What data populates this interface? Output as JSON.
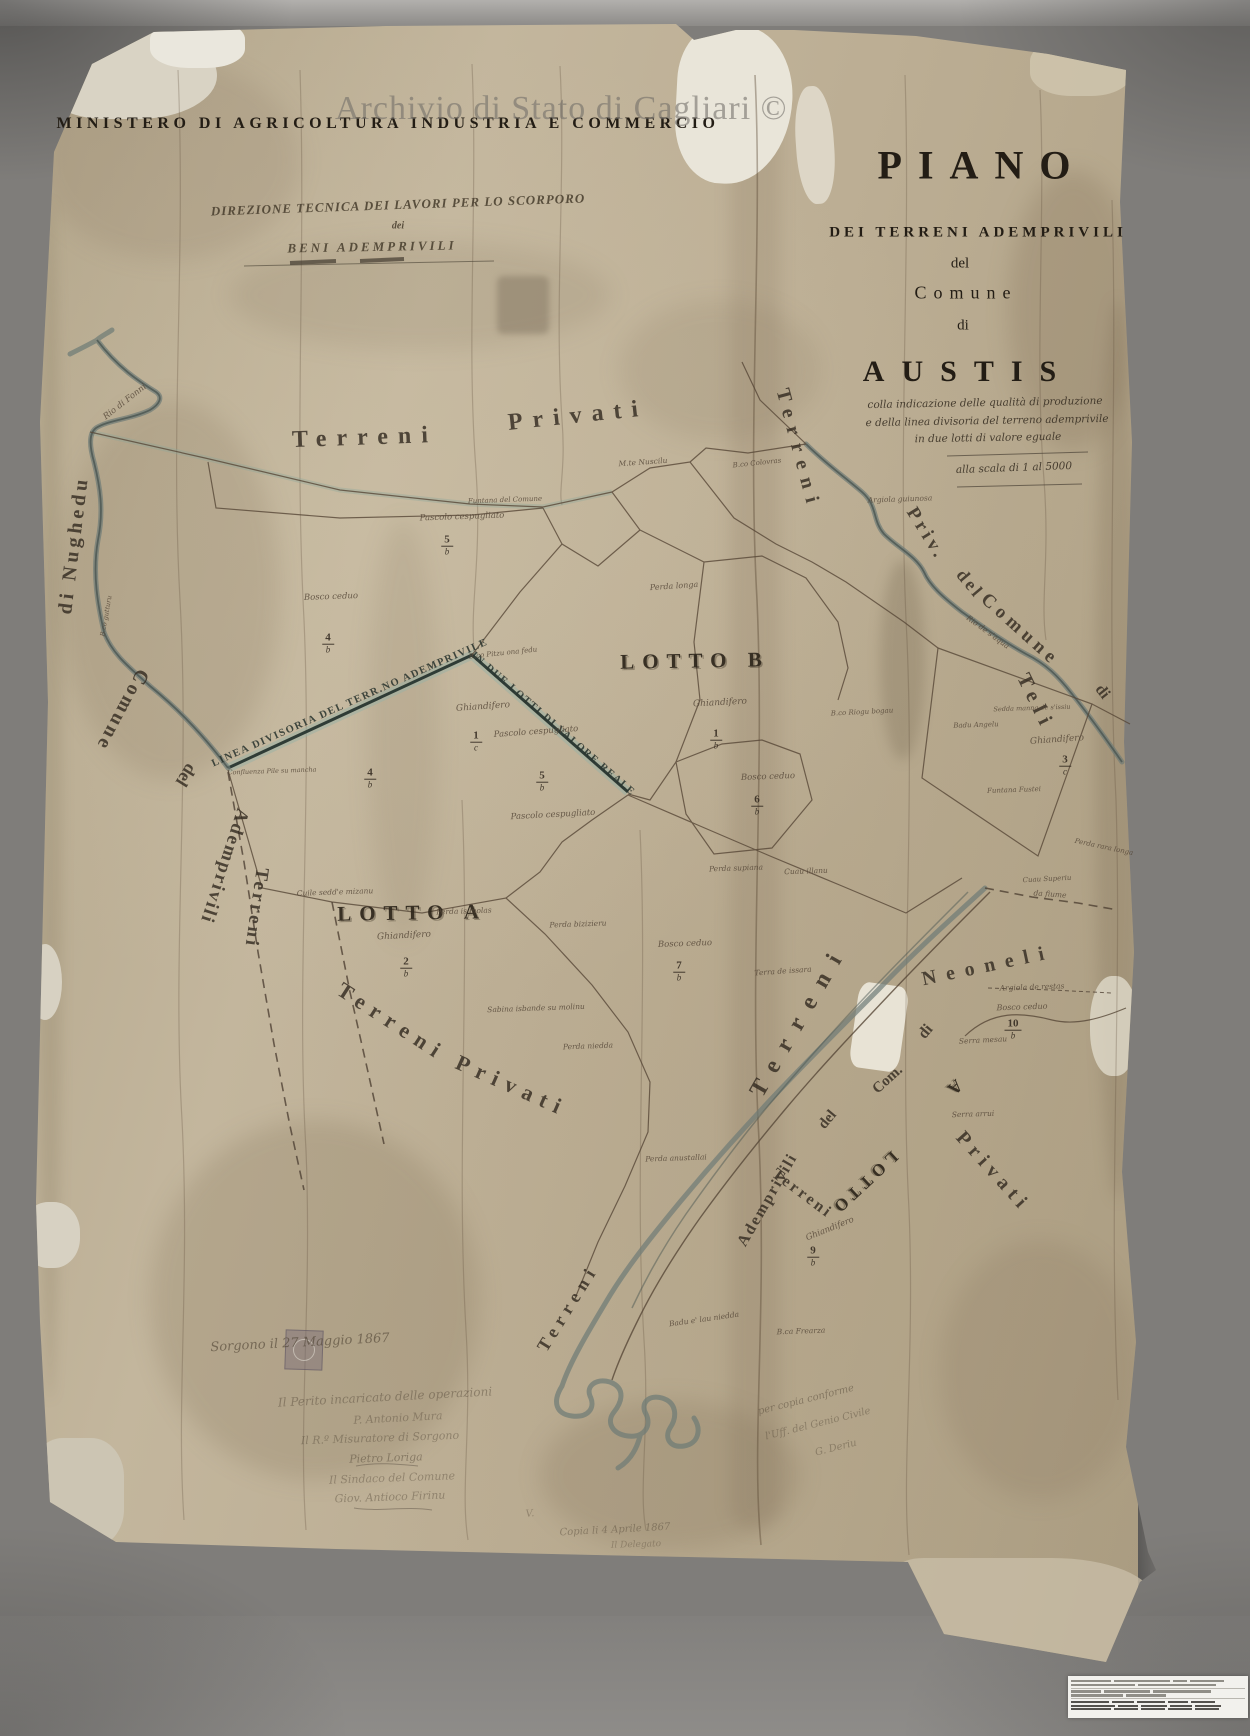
{
  "watermark": {
    "text": "Archivio di Stato di Cagliari ©"
  },
  "header": {
    "ministry": "MINISTERO DI AGRICOLTURA INDUSTRIA E COMMERCIO",
    "direction_line1": "DIREZIONE TECNICA DEI LAVORI PER LO SCORPORO",
    "direction_line2": "dei",
    "direction_line3": "BENI ADEMPRIVILI"
  },
  "title_block": {
    "title": "PIANO",
    "line1": "DEI TERRENI ADEMPRIVILI",
    "line2": "del",
    "line3": "Comune",
    "line4": "di",
    "comune": "AUSTIS",
    "sub1": "colla indicazione delle qualità di produzione",
    "sub2": "e della linea divisoria del terreno ademprivile",
    "sub3": "in due lotti di valore eguale",
    "scale": "alla scala di 1 al 5000"
  },
  "map": {
    "area_labels": [
      {
        "text": "Terreni",
        "x": 365,
        "y": 438,
        "rot": -2,
        "size": 24,
        "ls": 10
      },
      {
        "text": "Privati",
        "x": 578,
        "y": 416,
        "rot": -6,
        "size": 24,
        "ls": 10
      },
      {
        "text": "Terreni",
        "x": 392,
        "y": 1022,
        "rot": 33,
        "size": 22,
        "ls": 8
      },
      {
        "text": "Privati",
        "x": 512,
        "y": 1086,
        "rot": 24,
        "size": 22,
        "ls": 8
      },
      {
        "text": "Terreni",
        "x": 798,
        "y": 450,
        "rot": 75,
        "size": 20,
        "ls": 9
      },
      {
        "text": "Priv.",
        "x": 926,
        "y": 534,
        "rot": 58,
        "size": 19,
        "ls": 4
      },
      {
        "text": "del",
        "x": 970,
        "y": 584,
        "rot": 50,
        "size": 18,
        "ls": 3
      },
      {
        "text": "Comune",
        "x": 1020,
        "y": 630,
        "rot": 42,
        "size": 19,
        "ls": 5
      },
      {
        "text": "di",
        "x": 1102,
        "y": 692,
        "rot": 52,
        "size": 16
      },
      {
        "text": "Teli",
        "x": 1036,
        "y": 702,
        "rot": 64,
        "size": 21,
        "ls": 7
      },
      {
        "text": "di Nughedu",
        "x": 74,
        "y": 545,
        "rot": -83,
        "size": 20,
        "ls": 4
      },
      {
        "text": "Comune",
        "x": 122,
        "y": 710,
        "rot": 118,
        "size": 20,
        "ls": 3
      },
      {
        "text": "del",
        "x": 186,
        "y": 775,
        "rot": 122,
        "size": 18
      },
      {
        "text": "Ademprivili",
        "x": 224,
        "y": 866,
        "rot": 108,
        "size": 19,
        "ls": 2
      },
      {
        "text": "Terreni",
        "x": 256,
        "y": 908,
        "rot": 98,
        "size": 19,
        "ls": 3
      },
      {
        "text": "Terreni",
        "x": 800,
        "y": 1020,
        "rot": -60,
        "size": 24,
        "ls": 14
      },
      {
        "text": "Ademprivili",
        "x": 768,
        "y": 1200,
        "rot": -60,
        "size": 16,
        "ls": 2
      },
      {
        "text": "del",
        "x": 828,
        "y": 1120,
        "rot": -50,
        "size": 15
      },
      {
        "text": "Com.",
        "x": 888,
        "y": 1080,
        "rot": -42,
        "size": 15
      },
      {
        "text": "di",
        "x": 926,
        "y": 1032,
        "rot": -50,
        "size": 16
      },
      {
        "text": "Neoneli",
        "x": 988,
        "y": 966,
        "rot": -12,
        "size": 20,
        "ls": 10
      },
      {
        "text": "Terreni",
        "x": 568,
        "y": 1308,
        "rot": -58,
        "size": 18,
        "ls": 6
      },
      {
        "text": "Terreni",
        "x": 802,
        "y": 1194,
        "rot": 37,
        "size": 16,
        "ls": 3
      },
      {
        "text": "Privati",
        "x": 993,
        "y": 1172,
        "rot": 48,
        "size": 20,
        "ls": 6
      }
    ],
    "lot_labels": [
      {
        "text": "LOTTO B",
        "x": 695,
        "y": 661,
        "rot": -1,
        "size": 21,
        "ls": 8
      },
      {
        "text": "LOTTO A",
        "x": 412,
        "y": 913,
        "rot": -1,
        "size": 21,
        "ls": 8
      },
      {
        "text": "LOTTO",
        "x": 864,
        "y": 1183,
        "rot": 137,
        "size": 17,
        "ls": 5
      },
      {
        "text": "A",
        "x": 955,
        "y": 1087,
        "rot": 137,
        "size": 18
      }
    ],
    "captions": [
      {
        "text": "LINEA DIVISORIA DEL TERR.NO ADEMPRIVILE",
        "x": 350,
        "y": 703,
        "rot": -24,
        "size": 10.5,
        "ls": 1.5
      },
      {
        "text": "IN DUE LOTTI DI VALORE REALE",
        "x": 553,
        "y": 724,
        "rot": 41,
        "size": 10.5,
        "ls": 1.5
      }
    ],
    "small_labels": [
      {
        "text": "Rio di Fonni",
        "x": 125,
        "y": 402,
        "rot": -38,
        "size": 8.5
      },
      {
        "text": "B.co gutturu",
        "x": 106,
        "y": 616,
        "rot": -80,
        "size": 6.5
      },
      {
        "text": "M.te Nuscilu",
        "x": 643,
        "y": 462,
        "rot": -4,
        "size": 7.5
      },
      {
        "text": "Funtana del Comune",
        "x": 505,
        "y": 500,
        "rot": -2,
        "size": 7
      },
      {
        "text": "Pascolo cespugliato",
        "x": 462,
        "y": 517,
        "rot": -2,
        "size": 8.5
      },
      {
        "text": "Bosco ceduo",
        "x": 331,
        "y": 597,
        "rot": -2,
        "size": 8.5
      },
      {
        "text": "B.co Pitzu ona fedu",
        "x": 503,
        "y": 653,
        "rot": -6,
        "size": 7
      },
      {
        "text": "Confluenza Pile su mancha",
        "x": 272,
        "y": 771,
        "rot": -2,
        "size": 6.5
      },
      {
        "text": "Ghiandifero",
        "x": 483,
        "y": 707,
        "rot": -4,
        "size": 9
      },
      {
        "text": "Pascolo cespugliato",
        "x": 536,
        "y": 732,
        "rot": -4,
        "size": 8.5
      },
      {
        "text": "Pascolo cespugliato",
        "x": 553,
        "y": 815,
        "rot": -3,
        "size": 8.5
      },
      {
        "text": "Ghiandifero",
        "x": 720,
        "y": 703,
        "rot": -3,
        "size": 9
      },
      {
        "text": "Perda longa",
        "x": 674,
        "y": 586,
        "rot": -4,
        "size": 8
      },
      {
        "text": "B.co Colovras",
        "x": 757,
        "y": 463,
        "rot": -6,
        "size": 7
      },
      {
        "text": "Bosco ceduo",
        "x": 768,
        "y": 777,
        "rot": -2,
        "size": 8.5
      },
      {
        "text": "B.co Riogu bogau",
        "x": 862,
        "y": 712,
        "rot": -3,
        "size": 7
      },
      {
        "text": "Perda supiana",
        "x": 736,
        "y": 868,
        "rot": -2,
        "size": 7.5
      },
      {
        "text": "Cuau illanu",
        "x": 806,
        "y": 871,
        "rot": -2,
        "size": 7.5
      },
      {
        "text": "Argiola guiunosa",
        "x": 900,
        "y": 499,
        "rot": -2,
        "size": 7.5
      },
      {
        "text": "Rio de s'aqua",
        "x": 988,
        "y": 632,
        "rot": 36,
        "size": 7.5
      },
      {
        "text": "Sedda manna de s'issiu",
        "x": 1032,
        "y": 708,
        "rot": -2,
        "size": 6.5
      },
      {
        "text": "Badu Angelu",
        "x": 976,
        "y": 725,
        "rot": -2,
        "size": 7
      },
      {
        "text": "Ghiandifero",
        "x": 1057,
        "y": 740,
        "rot": -4,
        "size": 9
      },
      {
        "text": "Funtana Fustei",
        "x": 1014,
        "y": 790,
        "rot": -2,
        "size": 7
      },
      {
        "text": "Perda rara longa",
        "x": 1104,
        "y": 847,
        "rot": 12,
        "size": 7
      },
      {
        "text": "Cuau Superiu",
        "x": 1047,
        "y": 879,
        "rot": -3,
        "size": 7
      },
      {
        "text": "Cuile sedd'e mizanu",
        "x": 335,
        "y": 892,
        "rot": -2,
        "size": 7.5
      },
      {
        "text": "Perda is molas",
        "x": 464,
        "y": 911,
        "rot": -2,
        "size": 7.5
      },
      {
        "text": "Perda bizizieru",
        "x": 578,
        "y": 924,
        "rot": -2,
        "size": 7.5
      },
      {
        "text": "Ghiandifero",
        "x": 404,
        "y": 936,
        "rot": -3,
        "size": 9
      },
      {
        "text": "Bosco ceduo",
        "x": 685,
        "y": 944,
        "rot": -2,
        "size": 8.5
      },
      {
        "text": "Terra de issara",
        "x": 783,
        "y": 971,
        "rot": -4,
        "size": 7.5
      },
      {
        "text": "Sabina isbande su molinu",
        "x": 536,
        "y": 1008,
        "rot": -2,
        "size": 7.5
      },
      {
        "text": "Perda niedda",
        "x": 588,
        "y": 1046,
        "rot": -2,
        "size": 7.5
      },
      {
        "text": "Perda anustallai",
        "x": 676,
        "y": 1158,
        "rot": -2,
        "size": 7.5
      },
      {
        "text": "Argiola de restas",
        "x": 1032,
        "y": 987,
        "rot": -2,
        "size": 7.5
      },
      {
        "text": "Bosco ceduo",
        "x": 1022,
        "y": 1007,
        "rot": -2,
        "size": 8
      },
      {
        "text": "Serra mesau",
        "x": 983,
        "y": 1040,
        "rot": -3,
        "size": 7.5
      },
      {
        "text": "Serra arrui",
        "x": 973,
        "y": 1114,
        "rot": -2,
        "size": 7.5
      },
      {
        "text": "Ghiandifero",
        "x": 830,
        "y": 1229,
        "rot": -22,
        "size": 8.5
      },
      {
        "text": "Badu e' lau niedda",
        "x": 704,
        "y": 1319,
        "rot": -8,
        "size": 7.5
      },
      {
        "text": "B.ca Frearza",
        "x": 801,
        "y": 1331,
        "rot": -2,
        "size": 7.5
      },
      {
        "text": "da fiume",
        "x": 1050,
        "y": 894,
        "rot": 4,
        "size": 7.5
      }
    ],
    "fractions": [
      {
        "num": "5",
        "den": "b",
        "x": 447,
        "y": 546
      },
      {
        "num": "4",
        "den": "b",
        "x": 328,
        "y": 644
      },
      {
        "num": "1",
        "den": "c",
        "x": 476,
        "y": 742
      },
      {
        "num": "4",
        "den": "b",
        "x": 370,
        "y": 779
      },
      {
        "num": "5",
        "den": "b",
        "x": 542,
        "y": 782
      },
      {
        "num": "1",
        "den": "b",
        "x": 716,
        "y": 740
      },
      {
        "num": "6",
        "den": "b",
        "x": 757,
        "y": 806
      },
      {
        "num": "3",
        "den": "c",
        "x": 1065,
        "y": 766
      },
      {
        "num": "2",
        "den": "b",
        "x": 406,
        "y": 968
      },
      {
        "num": "7",
        "den": "b",
        "x": 679,
        "y": 972
      },
      {
        "num": "10",
        "den": "b",
        "x": 1013,
        "y": 1030
      },
      {
        "num": "9",
        "den": "b",
        "x": 813,
        "y": 1257
      }
    ]
  },
  "signatures": {
    "items": [
      {
        "text": "Sorgono il 27 Maggio 1867",
        "x": 300,
        "y": 1343,
        "rot": -3,
        "size": 13,
        "op": 0.6
      },
      {
        "text": "Il Perito incaricato delle operazioni",
        "x": 385,
        "y": 1397,
        "rot": -3,
        "size": 12,
        "op": 0.42
      },
      {
        "text": "P. Antonio Mura",
        "x": 398,
        "y": 1418,
        "rot": -3,
        "size": 11,
        "op": 0.38
      },
      {
        "text": "Il R.º Misuratore di Sorgono",
        "x": 380,
        "y": 1438,
        "rot": -2,
        "size": 11,
        "op": 0.4
      },
      {
        "text": "Pietro Loriga",
        "x": 386,
        "y": 1458,
        "rot": -2,
        "size": 11,
        "op": 0.45
      },
      {
        "text": "Il Sindaco del Comune",
        "x": 392,
        "y": 1478,
        "rot": -2,
        "size": 11,
        "op": 0.38
      },
      {
        "text": "Giov. Antioco Firinu",
        "x": 390,
        "y": 1497,
        "rot": -2,
        "size": 11,
        "op": 0.4
      },
      {
        "text": "V.",
        "x": 530,
        "y": 1514,
        "rot": -5,
        "size": 10,
        "op": 0.35
      },
      {
        "text": "Copia li 4 Aprile 1867",
        "x": 615,
        "y": 1530,
        "rot": -3,
        "size": 10,
        "op": 0.42
      },
      {
        "text": "Il Delegato",
        "x": 636,
        "y": 1545,
        "rot": -2,
        "size": 9,
        "op": 0.35
      },
      {
        "text": "per copia conforme",
        "x": 806,
        "y": 1400,
        "rot": -14,
        "size": 10,
        "op": 0.45
      },
      {
        "text": "l'Uff. del Genio Civile",
        "x": 818,
        "y": 1424,
        "rot": -14,
        "size": 10,
        "op": 0.4
      },
      {
        "text": "G. Deriu",
        "x": 836,
        "y": 1448,
        "rot": -14,
        "size": 10,
        "op": 0.4
      }
    ]
  },
  "colors": {
    "paper": "#bdaf96",
    "divider_line": "#2f3c36",
    "river": "#6d7b76",
    "ink": "#3a3126",
    "backdr": "#7f7d7a"
  }
}
